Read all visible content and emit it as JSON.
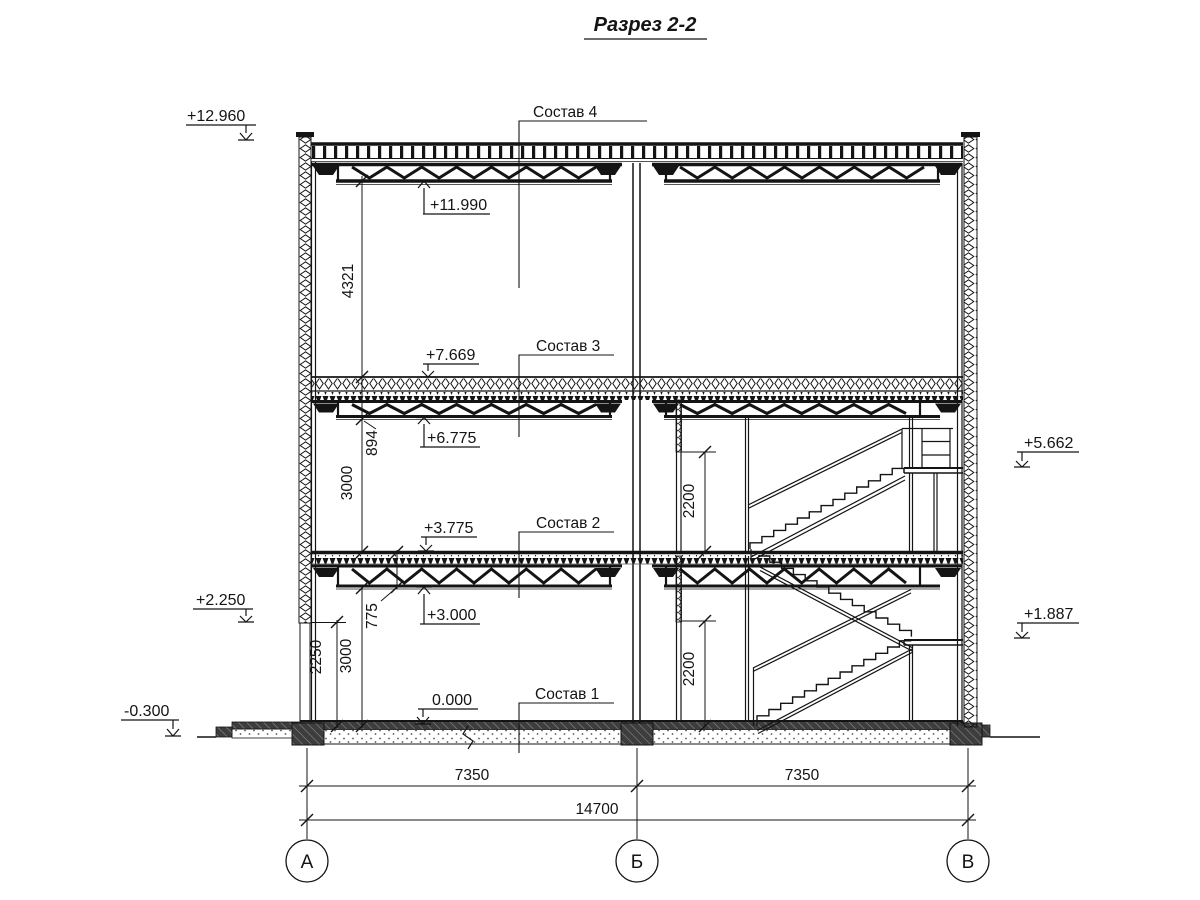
{
  "title": "Разрез 2-2",
  "colors": {
    "line": "#141414",
    "background": "#ffffff"
  },
  "labels": {
    "sostav4": "Состав 4",
    "sostav3": "Состав 3",
    "sostav2": "Состав 2",
    "sostav1": "Состав 1"
  },
  "elevations": {
    "e12960": "+12.960",
    "e11990": "+11.990",
    "e7669": "+7.669",
    "e6775": "+6.775",
    "e3775": "+3.775",
    "e3000": "+3.000",
    "e2250": "+2.250",
    "e0": "0.000",
    "em0300": "-0.300",
    "e5662": "+5.662",
    "e1887": "+1.887"
  },
  "dims": {
    "d4321": "4321",
    "d894": "894",
    "d3000u": "3000",
    "d775": "775",
    "d2250": "2250",
    "d3000l": "3000",
    "d2200u": "2200",
    "d2200l": "2200",
    "d7350l": "7350",
    "d7350r": "7350",
    "d14700": "14700"
  },
  "axes": {
    "a": "А",
    "b": "Б",
    "v": "В"
  }
}
